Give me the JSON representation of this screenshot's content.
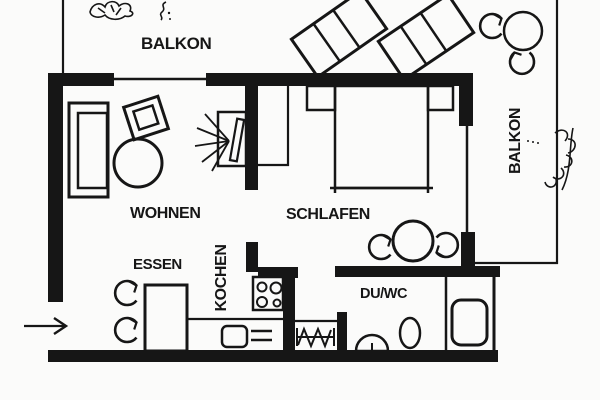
{
  "title": "Apartment floor plan",
  "colors": {
    "ink": "#161616",
    "background": "#fbfbfa"
  },
  "rooms": {
    "balcony_top": {
      "label": "BALKON"
    },
    "balcony_right": {
      "label": "BALKON"
    },
    "living": {
      "label": "WOHNEN"
    },
    "bedroom": {
      "label": "SCHLAFEN"
    },
    "dining": {
      "label": "ESSEN"
    },
    "kitchen": {
      "label": "KOCHEN"
    },
    "bathroom": {
      "label": "DU/WC"
    }
  },
  "furniture_icons": [
    "sofa-icon",
    "armchair-icon",
    "coffee-table-icon",
    "tv-icon",
    "wardrobe-icon",
    "double-bed-icon",
    "nightstand-icon",
    "round-table-icon",
    "chair-arrow-icon",
    "dining-table-icon",
    "stove-icon",
    "sink-icon",
    "radiator-icon",
    "washbasin-icon",
    "toilet-icon",
    "shower-icon",
    "deck-chair-icon",
    "balcony-table-icon",
    "plant-icon",
    "entrance-arrow-icon"
  ]
}
